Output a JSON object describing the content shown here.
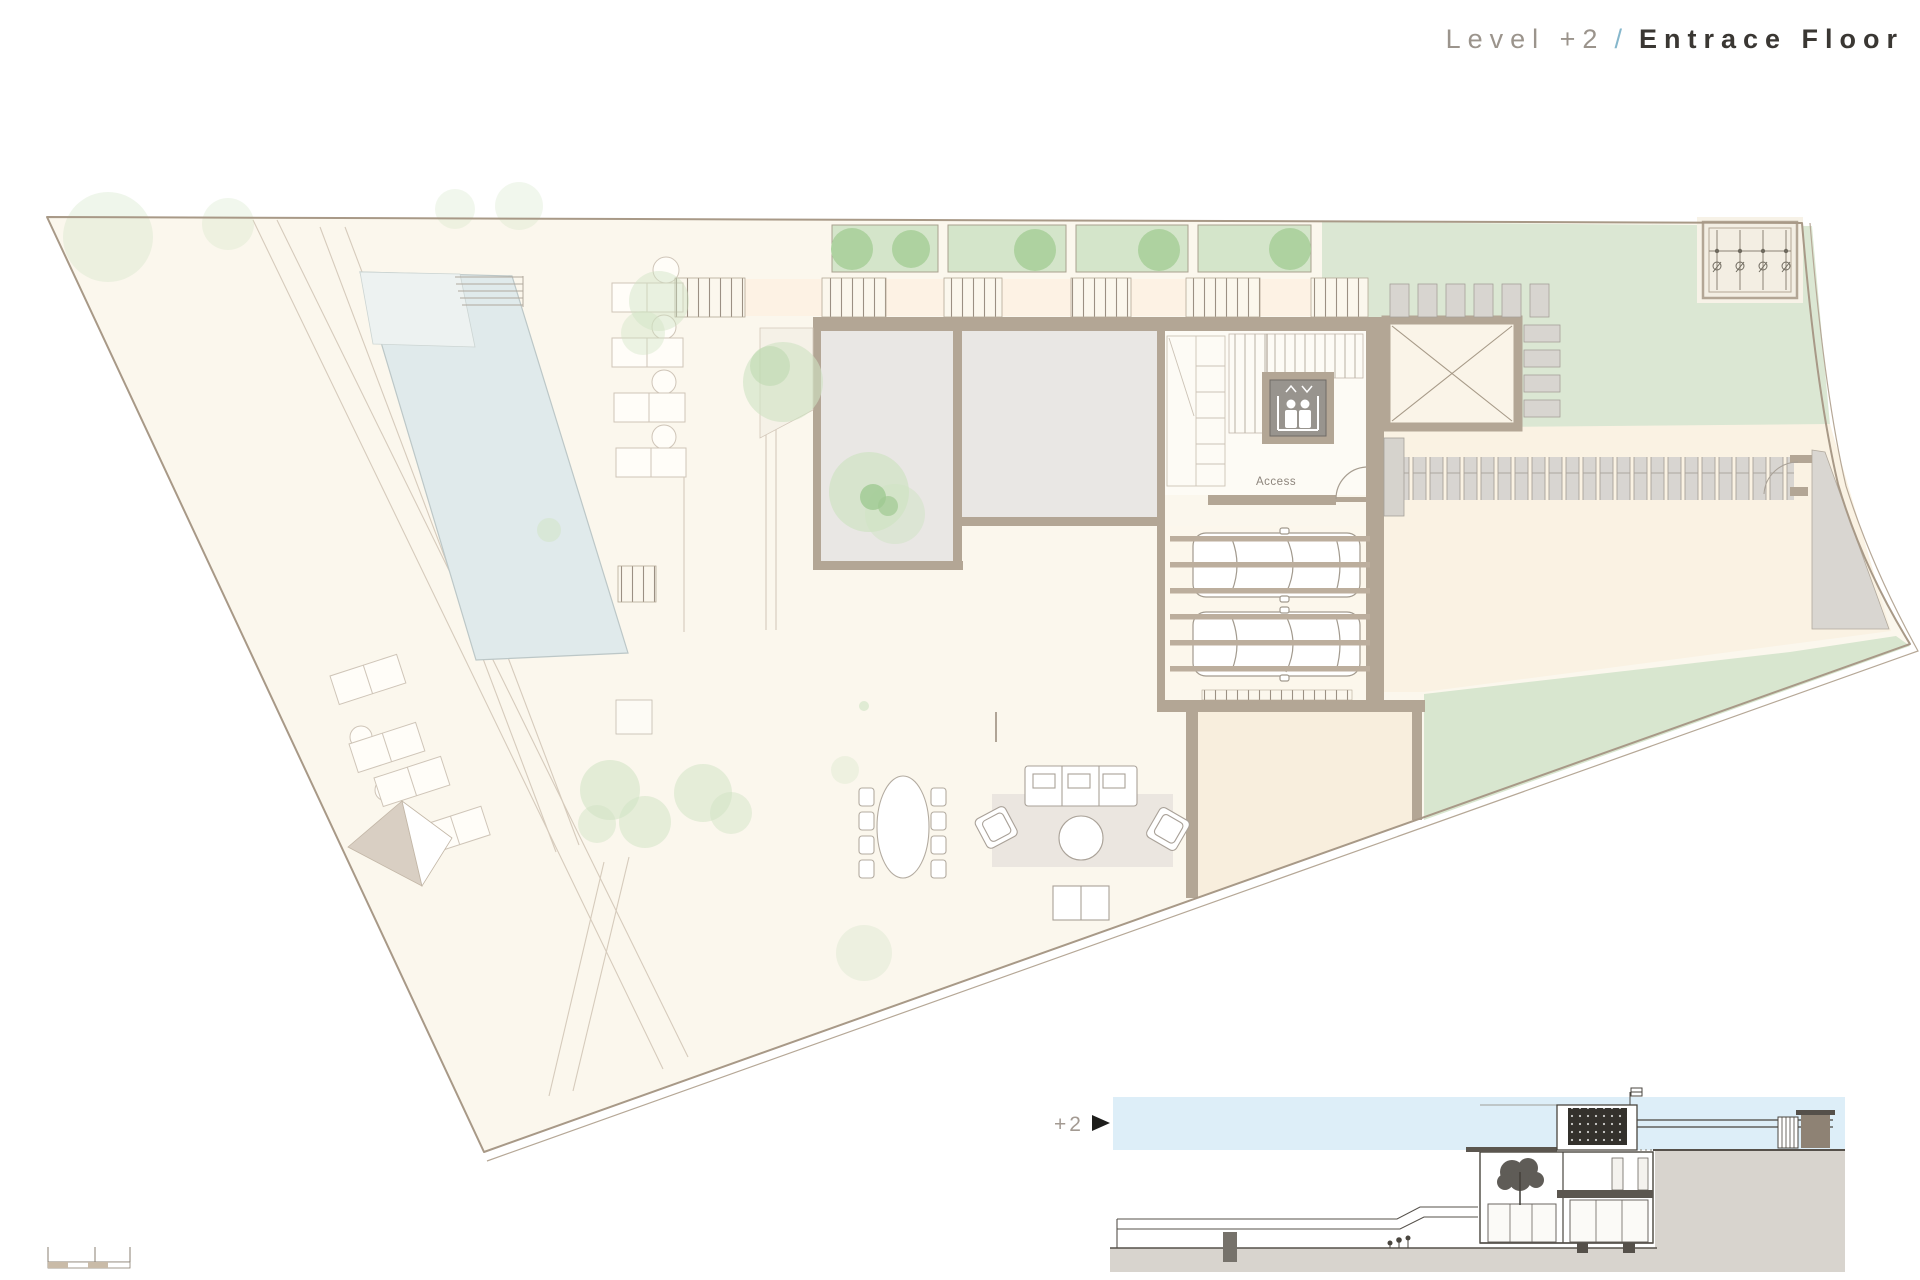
{
  "title": {
    "level": "Level +2",
    "separator": "/",
    "floor_name": "Entrace Floor"
  },
  "plan": {
    "access_label": "Access",
    "vehicle_count": 2
  },
  "section": {
    "level_marker": "+2",
    "marker_icon": "right-arrow-triangle"
  },
  "scale_bar": {
    "segments": 4
  },
  "icons": {
    "elevator": "elevator-people-icon"
  },
  "colors": {
    "title_gray": "#9b948c",
    "title_dark": "#3a3733",
    "slash_blue": "#86b7cc",
    "site_cream": "#fbf7ed",
    "wall_tan": "#b3a695",
    "room_gray": "#e9e7e4",
    "lawn_green": "#dbe7d3",
    "tree_green": "#aed2a0",
    "pool_blue": "#e0eaeb",
    "paver_gray": "#d8d5d0",
    "rug_beige": "#ebe6e0",
    "sky_blue": "#ddeef8",
    "ground_gray": "#d8d4ce"
  }
}
